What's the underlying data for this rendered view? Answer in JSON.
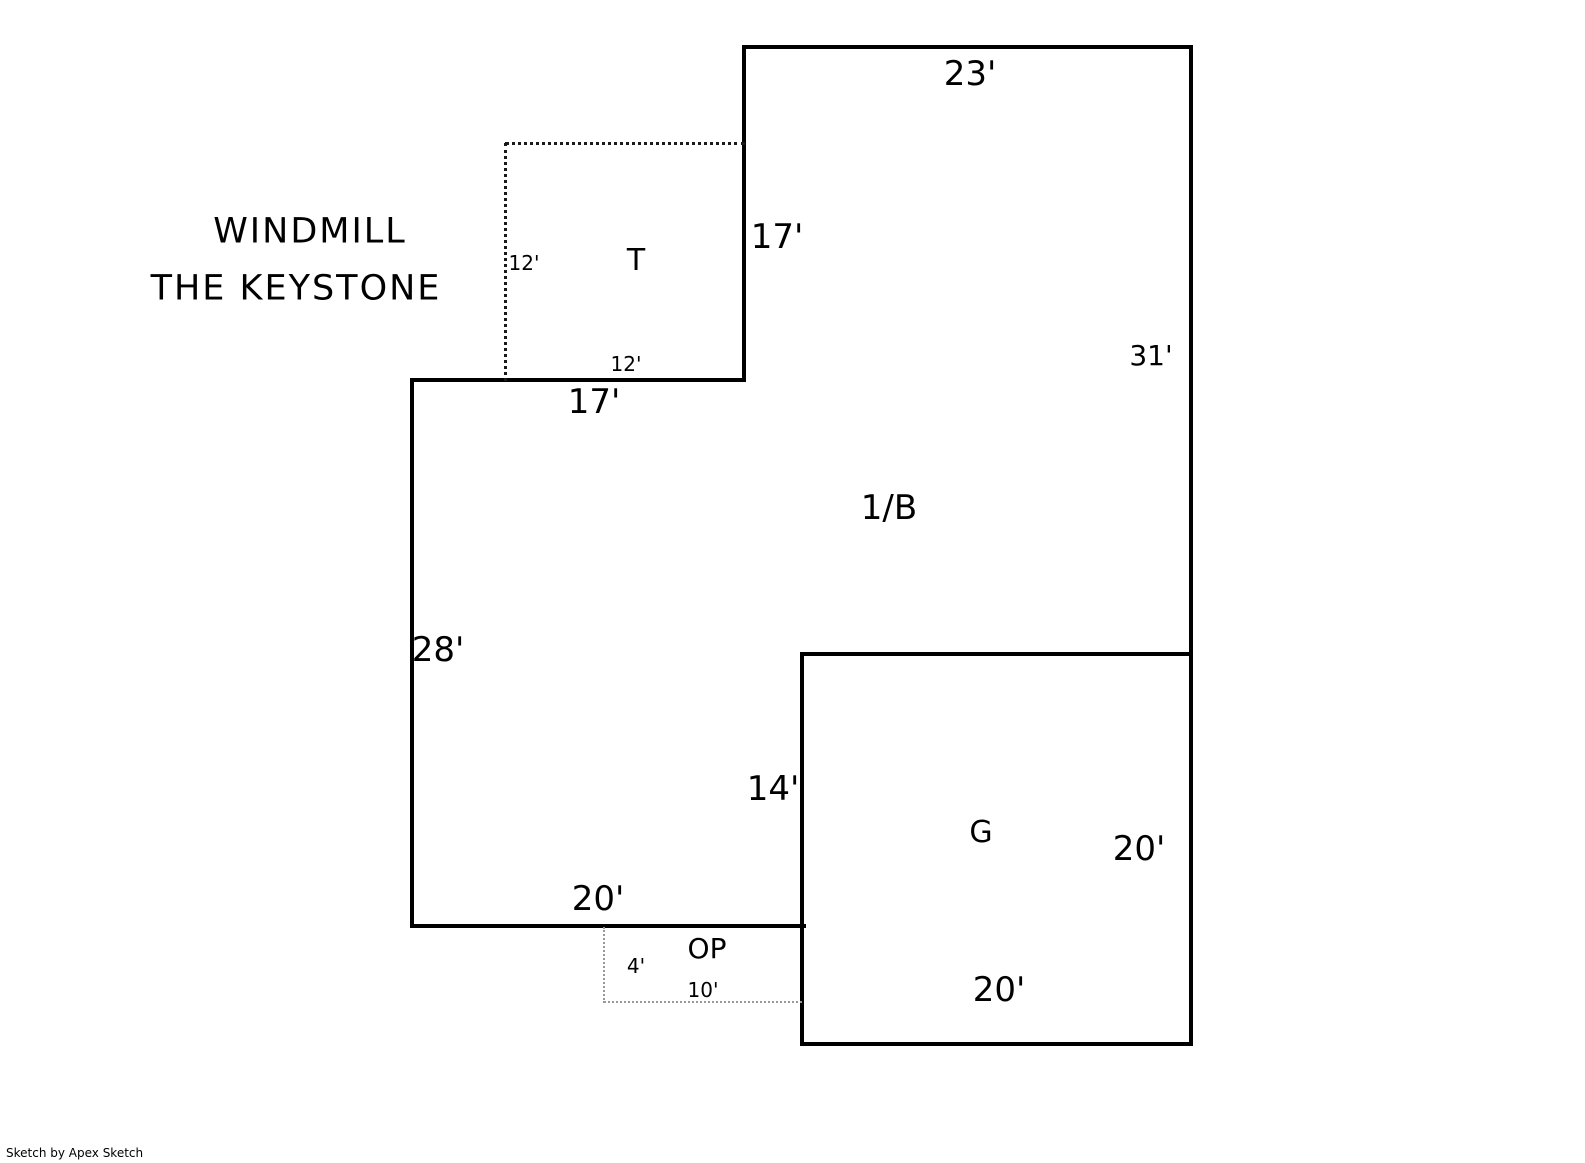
{
  "title": {
    "line1": "WINDMILL",
    "line2": "THE KEYSTONE"
  },
  "areas": {
    "main_floor": "1/B",
    "tower": "T",
    "garage": "G",
    "open_porch": "OP"
  },
  "dimensions": {
    "main_top": "23'",
    "main_upper_right_side": "17'",
    "main_right": "31'",
    "tower_left": "12'",
    "tower_bottom": "12'",
    "step_bottom": "17'",
    "main_left": "28'",
    "garage_left": "14'",
    "garage_right": "20'",
    "main_bottom": "20'",
    "porch_left": "4'",
    "porch_bottom": "10'",
    "garage_bottom": "20'"
  },
  "credit": "Sketch by Apex Sketch",
  "colors": {
    "wall": "#000000",
    "background": "#ffffff",
    "tower_dotted": "#1a1a1a",
    "porch_dotted": "#999999"
  }
}
